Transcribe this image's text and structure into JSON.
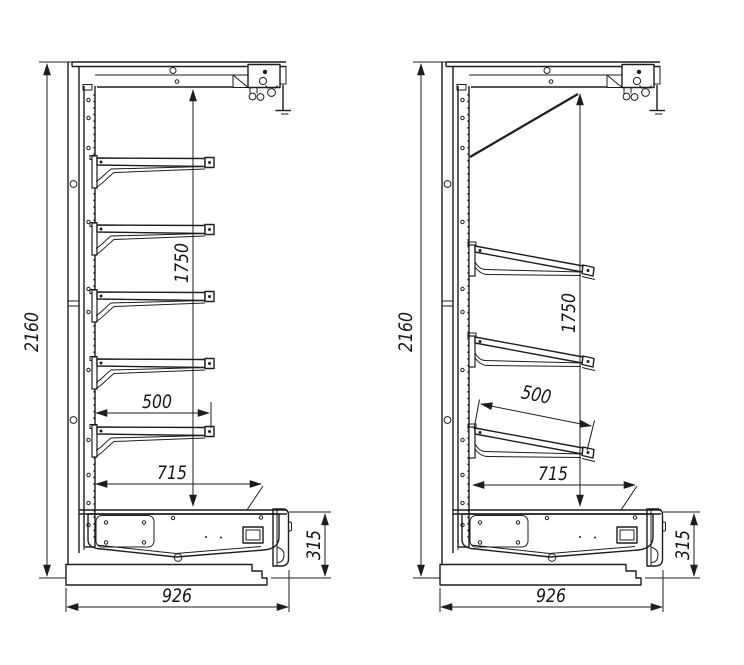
{
  "drawing": {
    "title": "Shelving unit side views with dimensions",
    "views": [
      {
        "name": "Side view, horizontal shelves",
        "shelf_count": 5,
        "dims": {
          "overall_height": "2160",
          "opening_height": "1750",
          "shelf_depth": "500",
          "base_depth": "715",
          "overall_depth": "926",
          "base_height": "315"
        }
      },
      {
        "name": "Side view, inclined shelves",
        "shelf_count": 3,
        "dims": {
          "overall_height": "2160",
          "opening_height": "1750",
          "shelf_depth": "500",
          "base_depth": "715",
          "overall_depth": "926",
          "base_height": "315"
        }
      }
    ]
  }
}
